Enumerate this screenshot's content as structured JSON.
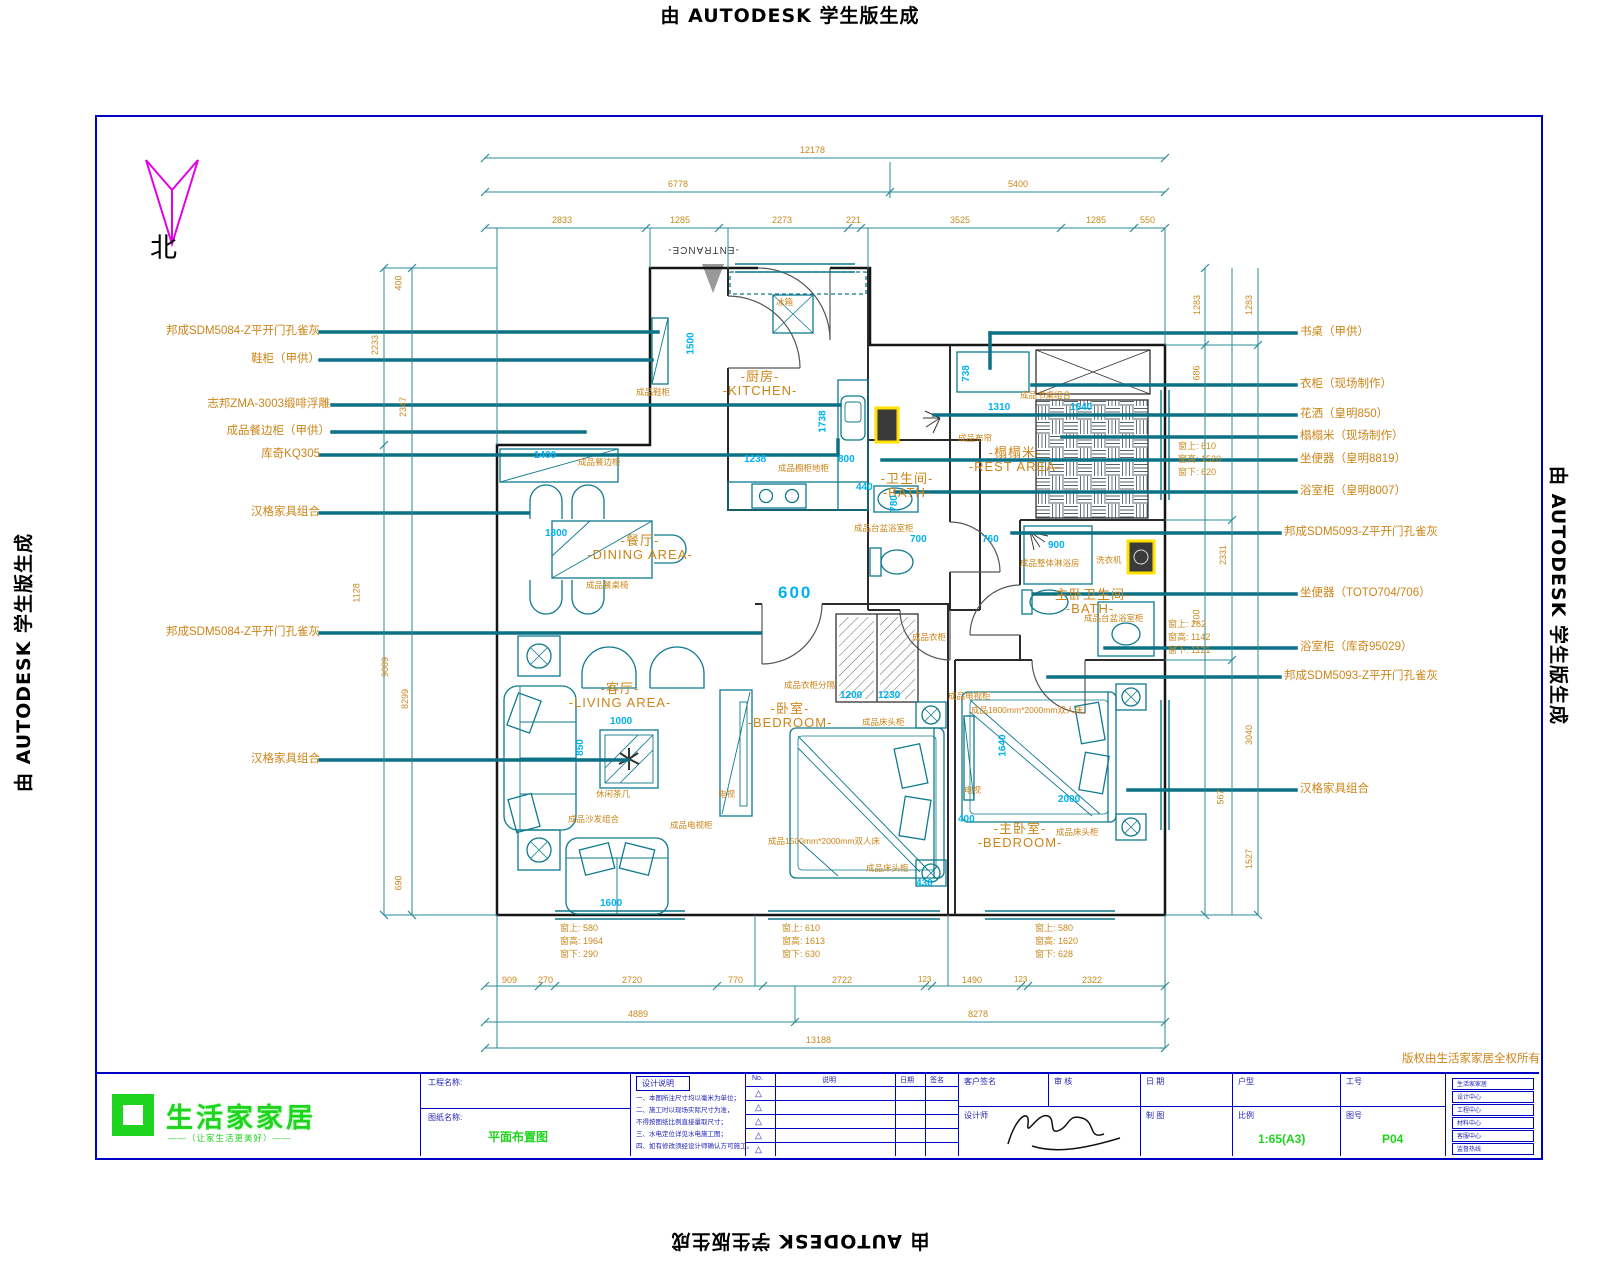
{
  "stamp": {
    "text": "由 AUTODESK 学生版生成"
  },
  "north_label": "北",
  "entrance_label": "-ENTRANCE-",
  "rooms": [
    {
      "cn": "-厨房-",
      "en": "-KITCHEN-"
    },
    {
      "cn": "-餐厅-",
      "en": "-DINING AREA-"
    },
    {
      "cn": "-客厅-",
      "en": "-LIVING AREA-"
    },
    {
      "cn": "-卧室-",
      "en": "-BEDROOM-"
    },
    {
      "cn": "-榻榻米-",
      "en": "-REST AREA-"
    },
    {
      "cn": "-卫生间-",
      "en": "-BATH-"
    },
    {
      "cn": "-主卧卫生间-",
      "en": "-BATH-"
    },
    {
      "cn": "-主卧室-",
      "en": "-BEDROOM-"
    }
  ],
  "labels_left": [
    "邦成SDM5084-Z平开门孔雀灰",
    "鞋柜（甲供）",
    "志邦ZMA-3003缎啡浮雕",
    "成品餐边柜（甲供）",
    "库奇KQ305",
    "汉格家具组合",
    "邦成SDM5084-Z平开门孔雀灰",
    "汉格家具组合"
  ],
  "labels_right": [
    "书桌（甲供）",
    "衣柜（现场制作）",
    "花洒（皇明850）",
    "榻榻米（现场制作）",
    "坐便器（皇明8819）",
    "浴室柜（皇明8007）",
    "邦成SDM5093-Z平开门孔雀灰",
    "坐便器（TOTO704/706）",
    "浴室柜（库奇95029）",
    "邦成SDM5093-Z平开门孔雀灰",
    "汉格家具组合"
  ],
  "notes": [
    "冰箱",
    "成品鞋柜",
    "成品橱柜地柜",
    "成品餐边柜",
    "成品餐桌椅",
    "休闲茶几",
    "成品沙发组合",
    "成品电视柜",
    "电视",
    "成品衣柜分隔",
    "成品衣柜",
    "成品床头柜",
    "成品床头柜",
    "成品1500mm*2000mm双人床",
    "成品1800mm*2000mm双人床",
    "成品床头柜",
    "成品电视柜",
    "电视",
    "成品书桌组合",
    "成品布帘",
    "洗衣机",
    "成品整体淋浴房",
    "成品台盆浴室柜",
    "成品台盆浴室柜"
  ],
  "win_dims": [
    [
      "窗上: 580",
      "窗高: 1964",
      "窗下: 290"
    ],
    [
      "窗上: 610",
      "窗高: 1613",
      "窗下: 630"
    ],
    [
      "窗上: 580",
      "窗高: 1620",
      "窗下: 628"
    ],
    [
      "窗上: 610",
      "窗高: 1520",
      "窗下: 620"
    ],
    [
      "窗上: 262",
      "窗高: 1142",
      "窗下: 1121"
    ]
  ],
  "dims": {
    "top1": [
      "12178"
    ],
    "top2": [
      "6778",
      "5400"
    ],
    "top3": [
      "2833",
      "1285",
      "2273",
      "221",
      "3525",
      "1285",
      "550"
    ],
    "bottom1": [
      "909",
      "270",
      "2720",
      "770",
      "2722",
      "123",
      "1490",
      "123",
      "2322"
    ],
    "bottom2": [
      "4889",
      "8278"
    ],
    "bottom3": [
      "13188"
    ],
    "left": [
      "400",
      "2233",
      "2347",
      "1128",
      "9089",
      "8299",
      "690"
    ],
    "right": [
      "1283",
      "1283",
      "686",
      "2331",
      "700",
      "3040",
      "567",
      "1527"
    ]
  },
  "cyan": {
    "door": "600",
    "cab": "1400",
    "table": "1800",
    "tea": "1000",
    "sofa_d": "850",
    "love": "1600",
    "k1": "1238",
    "k2": "800",
    "k3": "1738",
    "hall": "1500",
    "desk": "1310",
    "bench": "1640",
    "rest_d": "738",
    "b1": "440",
    "b2": "780",
    "d1": "700",
    "d2": "760",
    "w1": "1200",
    "w2": "1230",
    "bed1": "430",
    "mbed": "2000",
    "mbed_d": "1640",
    "m400": "400",
    "shower": "900"
  },
  "titleblock": {
    "copyright": "版权由生活家家居全权所有",
    "logo_text": "生活家家居",
    "logo_tagline": "——（让家生活更美好）——",
    "field_project": "工程名称:",
    "field_drawing": "图纸名称:",
    "drawing_name": "平面布置图",
    "notes_title": "设计说明",
    "notes_lines": [
      "一、本图所注尺寸均以毫米为单位；",
      "二、施工时以现场实际尺寸为准，",
      "不得按图纸比例直接量取尺寸；",
      "三、水电定位详见水电施工图；",
      "四、如有修改须经设计师确认方可施工。"
    ],
    "rev_headers": [
      "No.",
      "说明",
      "日期",
      "签名"
    ],
    "rev_mark": "△",
    "sig_labels": [
      "客户签名",
      "审 核",
      "日 期",
      "设计师",
      "制 图"
    ],
    "info_labels": [
      "户型",
      "工号",
      "比例",
      "图号"
    ],
    "scale_value": "1:65(A3)",
    "sheet_no": "P04",
    "side_boxes": [
      "生活家家居",
      "设计中心",
      "工程中心",
      "材料中心",
      "客服中心",
      "监督热线"
    ]
  },
  "colors": {
    "orange": "#cd8418",
    "cyan": "#00b1f1",
    "teal_leader": "#0d7186",
    "dim_line": "#2a8a9a",
    "sheet_border": "#0000c4",
    "logo_green": "#1fd41f",
    "north_magenta": "#e400e4",
    "highlight_yellow": "#ffe000"
  }
}
